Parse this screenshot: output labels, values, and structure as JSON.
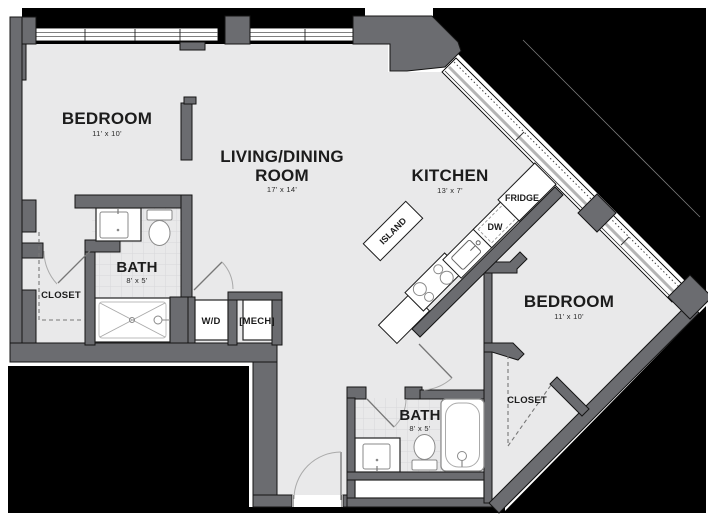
{
  "plan": {
    "title": "Apartment floor plan",
    "rooms": {
      "bedroom1": {
        "name": "BEDROOM",
        "dims": "11' x 10'"
      },
      "living": {
        "name_line1": "LIVING/DINING",
        "name_line2": "ROOM",
        "dims": "17' x 14'"
      },
      "kitchen": {
        "name": "KITCHEN",
        "dims": "13' x 7'"
      },
      "bath1": {
        "name": "BATH",
        "dims": "8' x 5'"
      },
      "closet1": {
        "name": "CLOSET"
      },
      "wd": {
        "name": "W/D"
      },
      "mech": {
        "name": "[MECH]"
      },
      "bedroom2": {
        "name": "BEDROOM",
        "dims": "11' x 10'"
      },
      "bath2": {
        "name": "BATH",
        "dims": "8' x 5'"
      },
      "closet2": {
        "name": "CLOSET"
      },
      "island": {
        "name": "ISLAND"
      },
      "fridge": {
        "name": "FRIDGE"
      },
      "dw": {
        "name": "DW"
      }
    },
    "colors": {
      "wall": "#6b6c70",
      "floor": "#e9e9ea",
      "exterior": "#000000",
      "fixture_line": "#8a8a8a",
      "tile_line": "#d8d8da"
    }
  }
}
